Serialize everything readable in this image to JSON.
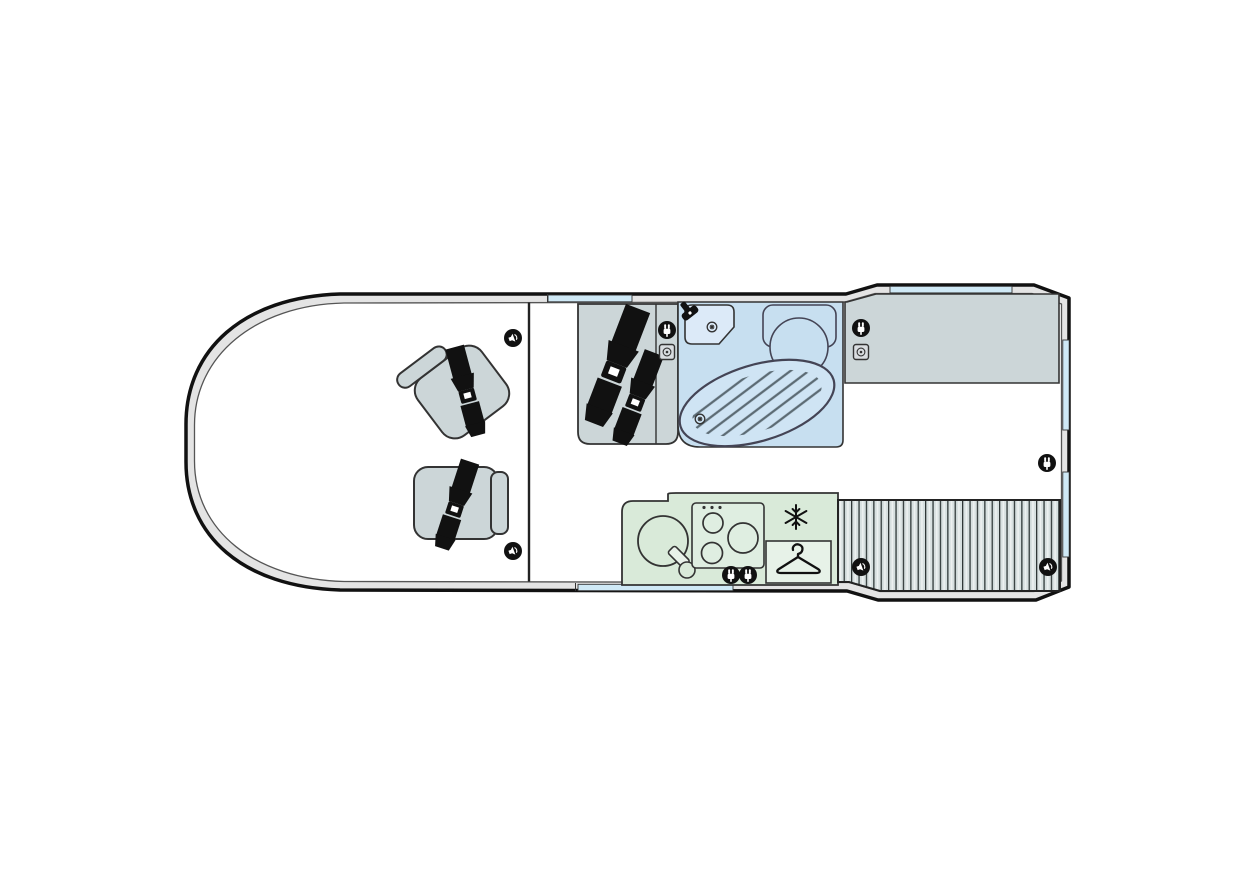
{
  "meta": {
    "type": "floor-plan",
    "subject": "motorhome-campervan-top-view"
  },
  "colors": {
    "wall_band": "#e4e4e4",
    "outline": "#111111",
    "floor": "#ffffff",
    "furniture_grey": "#ccd6d8",
    "bathroom_blue": "#c7dff0",
    "shower_blue": "#cfe4f4",
    "fixture_light_blue": "#dceaf8",
    "kitchen_green": "#d9ead9",
    "wardrobe_green": "#e7f2e8",
    "bed_grey": "#d7e0e0",
    "window_blue": "#cfe9f6",
    "door_blue": "#cfe9f6",
    "belt_black": "#111111",
    "icon_black": "#111111",
    "hatch_line": "#5c6b74"
  },
  "areas": {
    "cab": {
      "swivel_seats_with_belts": 2,
      "speakers": 2
    },
    "lounge": {
      "bench_seatbelts": 2,
      "power_sockets": 1,
      "aux_sockets": 1
    },
    "bathroom": {
      "fixtures": [
        "washbasin",
        "faucet",
        "toilet",
        "shower-tray",
        "drain"
      ]
    },
    "kitchen": {
      "hob_burners": 3,
      "features": [
        "round-sink",
        "faucet",
        "fridge-snowflake",
        "power-sockets"
      ]
    },
    "wardrobe": {
      "icon": "hanger"
    },
    "rear_bed": {
      "slatted": true,
      "speakers": 2
    },
    "sideboard": {
      "power_sockets": 1,
      "aux_sockets": 1
    }
  },
  "icons": {
    "speaker": "speaker-icon",
    "power_socket": "power-socket-icon",
    "aux_socket": "aux-socket-icon",
    "fridge": "snowflake-icon",
    "hanger": "hanger-icon",
    "drain": "drain-icon",
    "faucet": "faucet-icon",
    "seatbelt": "seatbelt-icon"
  },
  "counts": {
    "speakers": 4,
    "power_sockets": 5,
    "aux_sockets": 2,
    "windows": 4,
    "entry_doors": 1,
    "belted_seats": 4,
    "hob_burners": 3
  }
}
